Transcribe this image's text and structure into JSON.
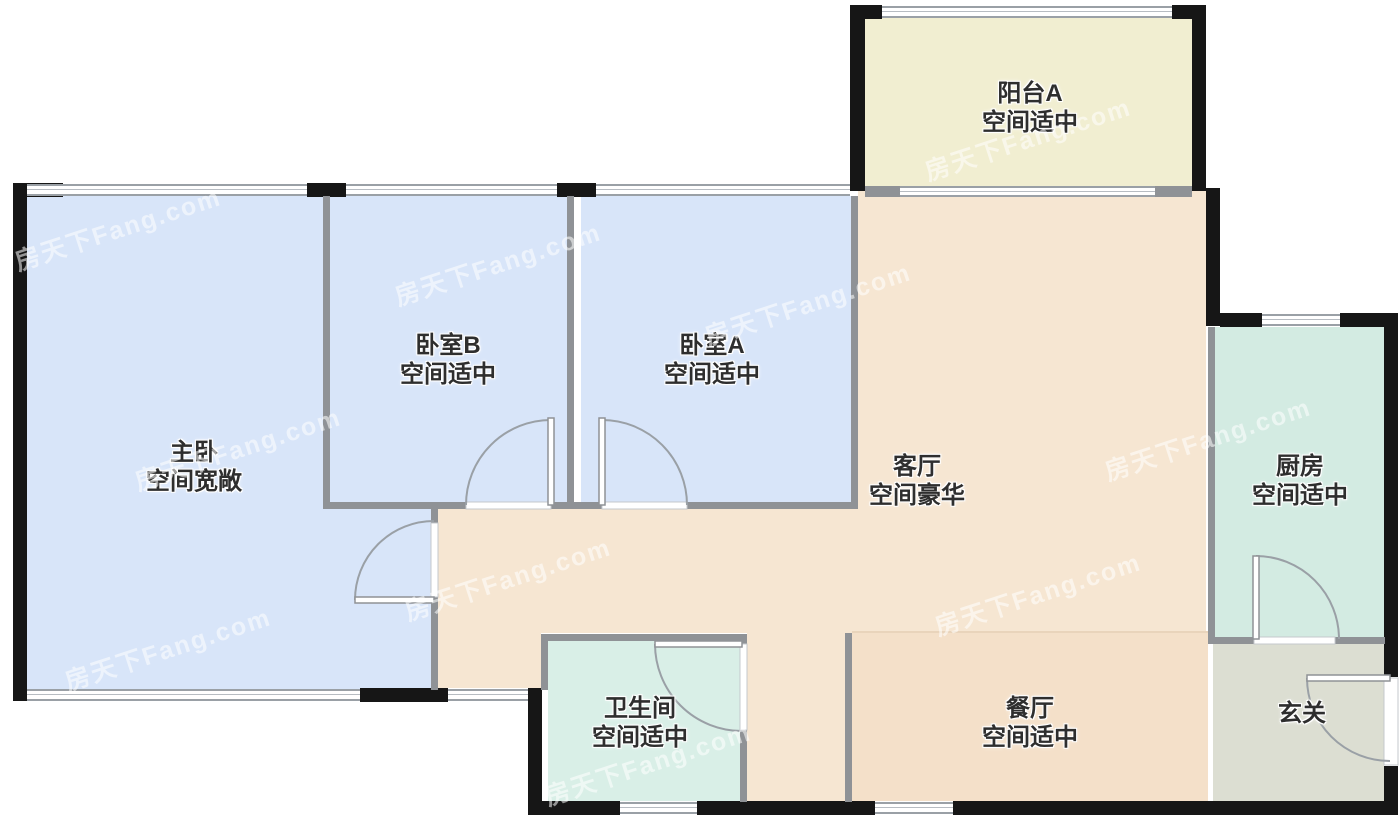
{
  "plan": {
    "watermark_text": "房天下Fang.com",
    "rooms": [
      {
        "id": "balcony-a",
        "label": "阳台A",
        "note": "空间适中",
        "floor_color": "#f1eed1"
      },
      {
        "id": "bedroom-b",
        "label": "卧室B",
        "note": "空间适中",
        "floor_color": "#d8e5f9"
      },
      {
        "id": "bedroom-a",
        "label": "卧室A",
        "note": "空间适中",
        "floor_color": "#d8e5f9"
      },
      {
        "id": "master-bedroom",
        "label": "主卧",
        "note": "空间宽敞",
        "floor_color": "#d8e5f9"
      },
      {
        "id": "living-room",
        "label": "客厅",
        "note": "空间豪华",
        "floor_color": "#f6e6d2"
      },
      {
        "id": "kitchen",
        "label": "厨房",
        "note": "空间适中",
        "floor_color": "#d3ebe2"
      },
      {
        "id": "bathroom",
        "label": "卫生间",
        "note": "空间适中",
        "floor_color": "#d9efe7"
      },
      {
        "id": "dining-room",
        "label": "餐厅",
        "note": "空间适中",
        "floor_color": "#f4e0c9"
      },
      {
        "id": "foyer",
        "label": "玄关",
        "note": "",
        "floor_color": "#dcded2"
      }
    ],
    "colors": {
      "exterior_wall": "#161616",
      "interior_wall": "#8f9296",
      "window_frame": "#9aa0a6",
      "door_arc": "#9aa0a6",
      "background": "#ffffff",
      "living_dining_divider": "#e9d4bb"
    }
  }
}
